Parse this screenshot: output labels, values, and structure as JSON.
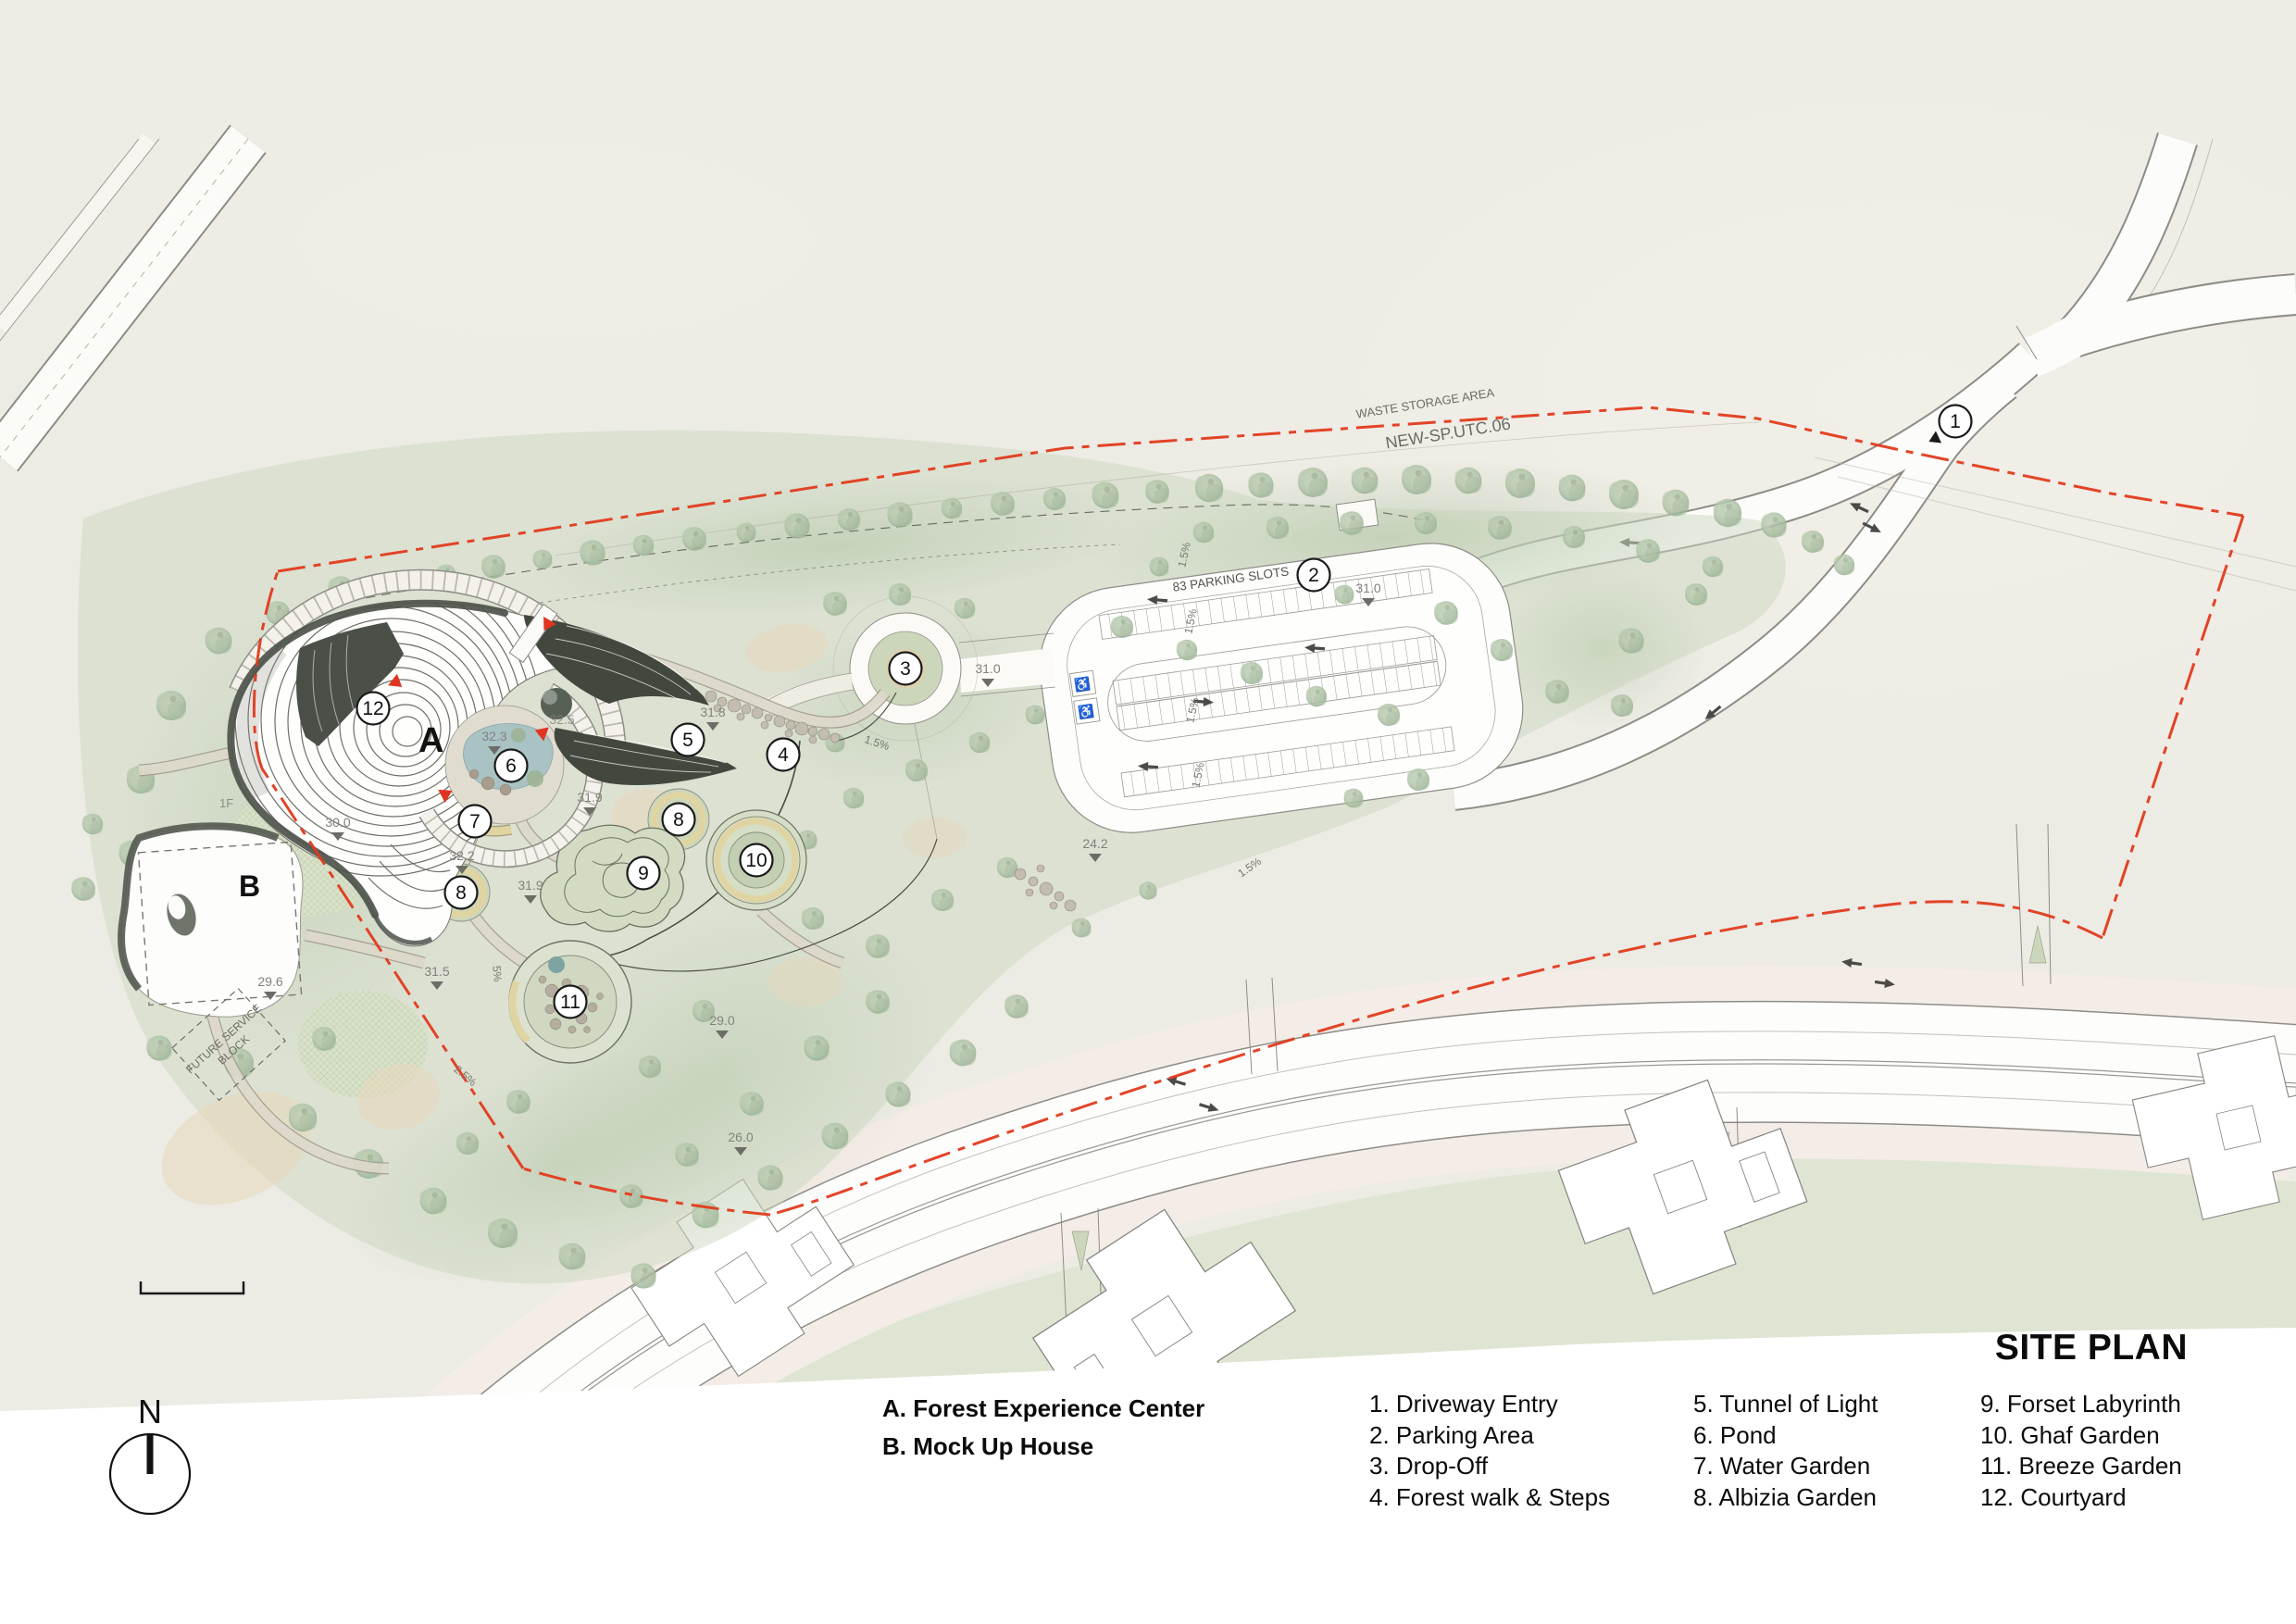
{
  "title": "SITE PLAN",
  "compass": {
    "label": "N"
  },
  "legend": {
    "buildings": [
      "A. Forest Experience Center",
      "B. Mock Up House"
    ],
    "col1": [
      "1. Driveway Entry",
      "2. Parking Area",
      "3. Drop-Off",
      "4. Forest walk & Steps"
    ],
    "col2": [
      "5. Tunnel of Light",
      "6. Pond",
      "7. Water Garden",
      "8. Albizia Garden"
    ],
    "col3": [
      "9. Forset Labyrinth",
      "10. Ghaf Garden",
      "11. Breeze Garden",
      "12. Courtyard"
    ]
  },
  "plan": {
    "labels": {
      "waste_area": "WASTE STORAGE AREA",
      "parcel": "NEW-SP.UTC.06",
      "parking_slots": "83 PARKING SLOTS",
      "future_block_line1": "FUTURE SERVICE",
      "future_block_line2": "BLOCK",
      "floor": "1F",
      "building_a": "A",
      "building_b": "B"
    },
    "markers": [
      "1",
      "2",
      "3",
      "4",
      "5",
      "6",
      "7",
      "8",
      "9",
      "10",
      "11",
      "12"
    ],
    "elevations": [
      "30.0",
      "32.3",
      "31.8",
      "31.9",
      "32.2",
      "31.9",
      "31.5",
      "29.0",
      "26.0",
      "29.6",
      "24.2",
      "31.0",
      "31.0",
      "32.5"
    ],
    "slopes": [
      "1.5%",
      "1.5%",
      "1.5%",
      "1.5%",
      "1.5%",
      "1.5%",
      "5%",
      "2.5%"
    ],
    "colors": {
      "boundary": "#e23a1c",
      "water": "#a9c3c4",
      "canopy": "#aec2a6",
      "road": "#fdfdfc",
      "sidewalk": "#f4ece6",
      "villa_lawn": "#dfe5d3",
      "structure_dark": "#4d524b",
      "accent_ring": "#e0d5a2"
    }
  }
}
